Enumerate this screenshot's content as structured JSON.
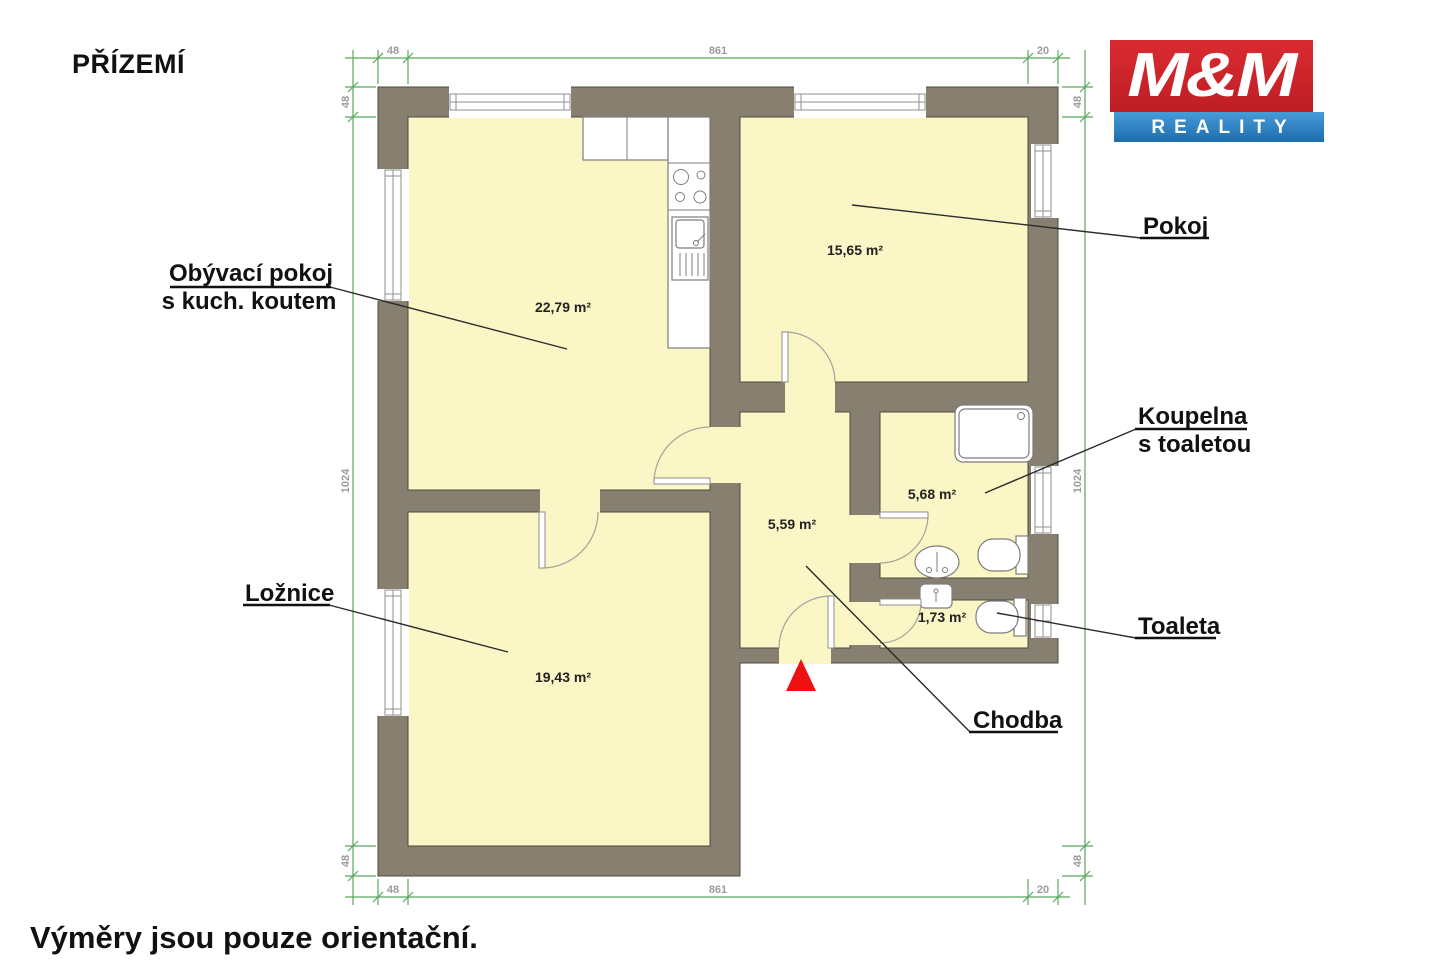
{
  "page": {
    "title": "PŘÍZEMÍ",
    "footer": "Výměry jsou pouze orientační."
  },
  "logo": {
    "line1": "M&M",
    "line2": "REALITY"
  },
  "rooms": {
    "living": {
      "label1": "Obývací pokoj",
      "label2": "s kuch. koutem",
      "area": "22,79 m²"
    },
    "pokoj": {
      "label": "Pokoj",
      "area": "15,65 m²"
    },
    "koupelna": {
      "label1": "Koupelna",
      "label2": "s toaletou",
      "area": "5,68 m²"
    },
    "toaleta": {
      "label": "Toaleta",
      "area": "1,73 m²"
    },
    "chodba": {
      "label": "Chodba",
      "area": "5,59 m²"
    },
    "loznice": {
      "label": "Ložnice",
      "area": "19,43 m²"
    }
  },
  "dimensions": {
    "top": {
      "d1": "48",
      "d2": "861",
      "d3": "20"
    },
    "bottom": {
      "d1": "48",
      "d2": "861",
      "d3": "20"
    },
    "left": {
      "d1": "48",
      "d2": "1024",
      "d3": "48"
    },
    "right": {
      "d1": "48",
      "d2": "1024",
      "d3": "48"
    }
  },
  "colors": {
    "wall": "#877f70",
    "room_fill": "#faf6c5",
    "dimension_green": "#58a85c",
    "logo_red": "#d2232b",
    "logo_blue": "#2e86c5",
    "entrance_arrow_red": "#ee1111"
  }
}
